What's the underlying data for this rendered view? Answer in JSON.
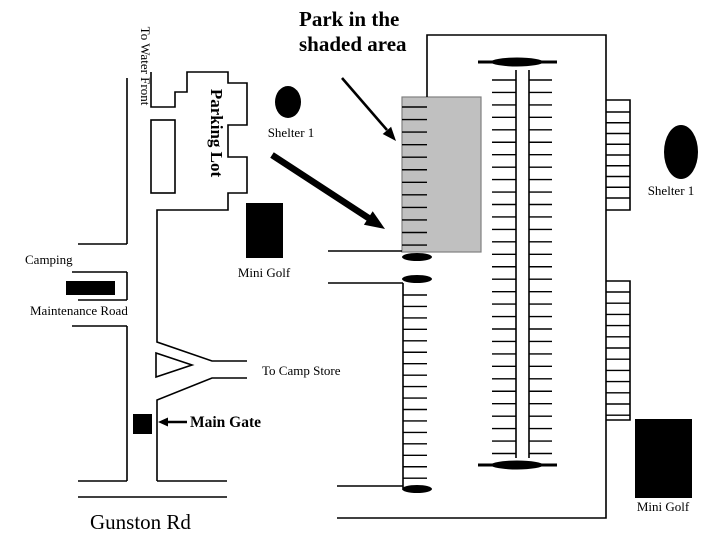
{
  "title": {
    "line1": "Park in the",
    "line2": "shaded area"
  },
  "labels": {
    "to_water_front": "To Water Front",
    "parking_lot": "Parking Lot",
    "shelter1_left": "Shelter 1",
    "shelter1_right": "Shelter 1",
    "camping": "Camping",
    "maintenance_road": "Maintenance Road",
    "mini_golf_left": "Mini Golf",
    "mini_golf_right": "Mini Golf",
    "to_camp_store": "To Camp Store",
    "main_gate": "Main Gate",
    "gunston_rd": "Gunston Rd"
  },
  "colors": {
    "ink": "#000000",
    "background": "#ffffff",
    "shaded_area": "#c0c0c0",
    "shaded_area_border": "#808080"
  },
  "map": {
    "tick_groups": [
      {
        "name": "ticks-shaded-area",
        "x1": 402,
        "x2": 427,
        "y": 107,
        "dy": 12.55,
        "count": 12
      },
      {
        "name": "ticks-loop-left",
        "x1": 492,
        "x2": 516,
        "y": 80,
        "dy": 12.45,
        "count": 31
      },
      {
        "name": "ticks-loop-right",
        "x1": 529,
        "x2": 552,
        "y": 80,
        "dy": 12.45,
        "count": 31
      },
      {
        "name": "ticks-east-upper",
        "x1": 606,
        "x2": 630,
        "y": 112,
        "dy": 10.75,
        "count": 9
      },
      {
        "name": "ticks-east-lower",
        "x1": 606,
        "x2": 630,
        "y": 292,
        "dy": 11.2,
        "count": 12
      },
      {
        "name": "ticks-west-ladder",
        "x1": 403,
        "x2": 427,
        "y": 295,
        "dy": 11.45,
        "count": 17
      }
    ]
  }
}
